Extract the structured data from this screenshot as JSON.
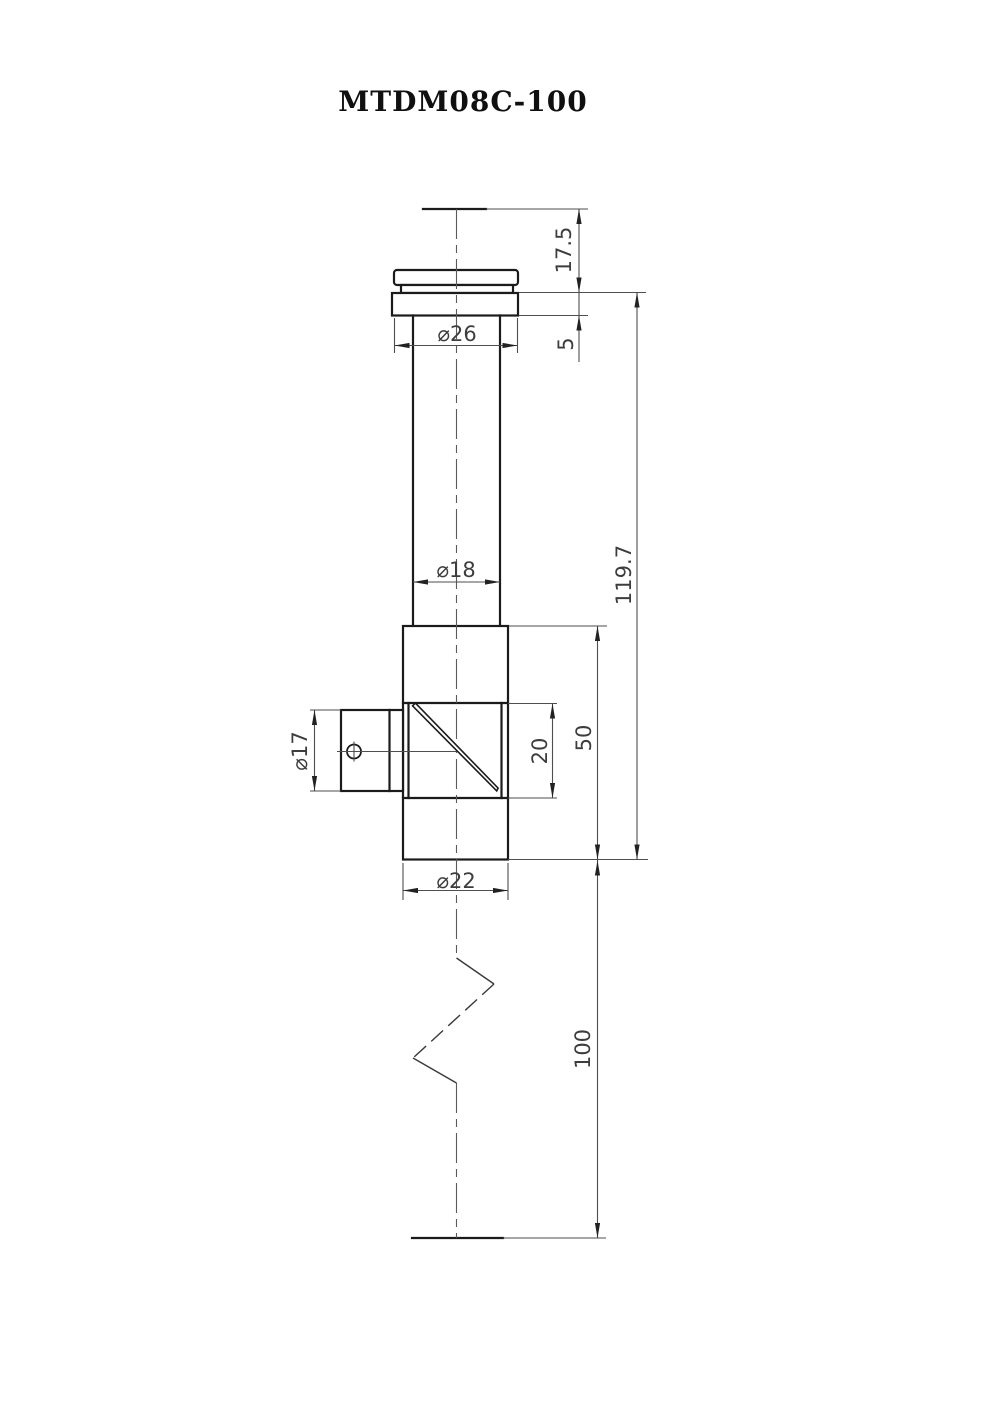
{
  "title": "MTDM08C-100",
  "dims": {
    "tip_length": "17.5",
    "collar_height": "5",
    "cap_diameter": "⌀26",
    "tube_diameter": "⌀18",
    "overall_length": "119.7",
    "body_length": "50",
    "window_height": "20",
    "port_diameter": "⌀17",
    "body_diameter": "⌀22",
    "rod_length": "100"
  }
}
